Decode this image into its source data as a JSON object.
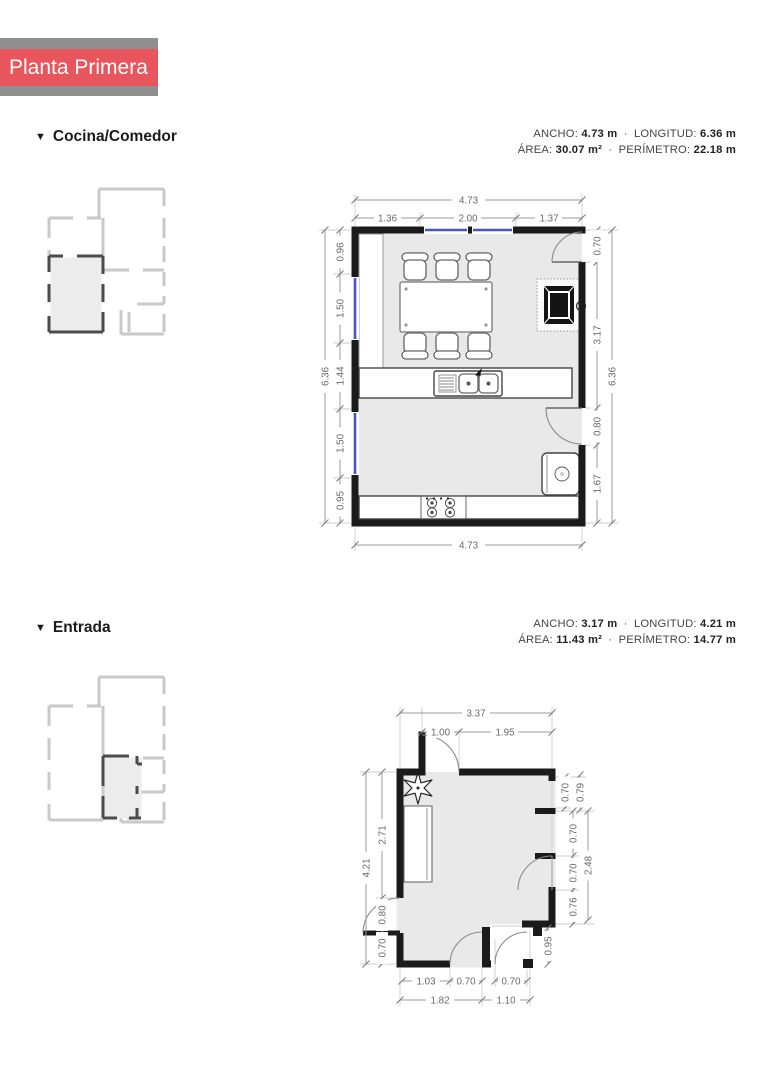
{
  "banner": {
    "title": "Planta Primera"
  },
  "ui": {
    "section_marker": "▼",
    "dot_sep": "·"
  },
  "cocina": {
    "title": "Cocina/Comedor",
    "stats": {
      "ancho_label": "ANCHO:",
      "ancho_value": "4.73 m",
      "longitud_label": "LONGITUD:",
      "longitud_value": "6.36 m",
      "area_label": "ÁREA:",
      "area_value": "30.07 m²",
      "perimetro_label": "PERÍMETRO:",
      "perimetro_value": "22.18 m"
    },
    "dims": {
      "top_total": "4.73",
      "top_segments": [
        "1.36",
        "2.00",
        "1.37"
      ],
      "left_total": "6.36",
      "left_segments": [
        "0.96",
        "1.50",
        "1.44",
        "1.50",
        "0.95"
      ],
      "right_total": "6.36",
      "right_segments": [
        "0.70",
        "3.17",
        "0.80",
        "1.67"
      ],
      "bottom_total": "4.73"
    }
  },
  "entrada": {
    "title": "Entrada",
    "stats": {
      "ancho_label": "ANCHO:",
      "ancho_value": "3.17 m",
      "longitud_label": "LONGITUD:",
      "longitud_value": "4.21 m",
      "area_label": "ÁREA:",
      "area_value": "11.43 m²",
      "perimetro_label": "PERÍMETRO:",
      "perimetro_value": "14.77 m"
    },
    "dims": {
      "top_total": "3.37",
      "top_segments": [
        "1.00",
        "1.95"
      ],
      "left_total": "4.21",
      "left_segments": [
        "2.71",
        "0.80",
        "0.70"
      ],
      "right_inner": [
        "0.70",
        "0.70",
        "0.70",
        "0.76"
      ],
      "right_outer_top": "0.79",
      "right_outer_mid": "2.48",
      "right_bottom": "0.95",
      "bottom_segments": [
        "1.03",
        "0.70",
        "0.70"
      ],
      "bottom_totals": [
        "1.82",
        "1.10"
      ]
    }
  }
}
